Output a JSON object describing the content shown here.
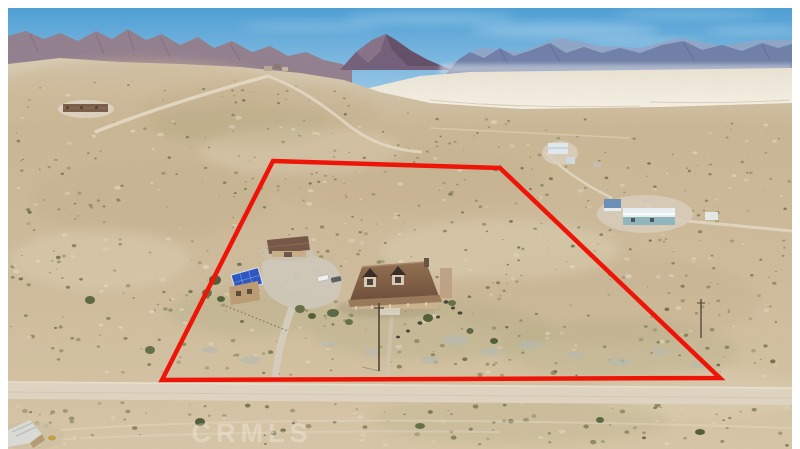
{
  "photo": {
    "description_watermark": "CRMLS"
  },
  "watermark": {
    "text": "CRMLS"
  },
  "boundary": {
    "points": "273,161 500,168 720,378 162,380",
    "color": "#ee1508",
    "stroke_width": "4.5"
  },
  "colors": {
    "sky_top": "#4f9fd4",
    "sky_horizon": "#c8e0ef",
    "mountain_left": "#93808f",
    "mountain_center": "#74607a",
    "mountain_right": "#7080a8",
    "dry_lake_bed": "#f0eadd",
    "desert": "#cdbb9b",
    "road": "#ddd3c0",
    "house_roof": "#7b5a43",
    "garage_roof": "#77594a",
    "solar_panel": "#2e57c0",
    "shrub_palette": [
      "#6b6f46",
      "#7a7c52",
      "#5d6342",
      "#848a5e"
    ],
    "sand_light": "#e6dcc6"
  }
}
